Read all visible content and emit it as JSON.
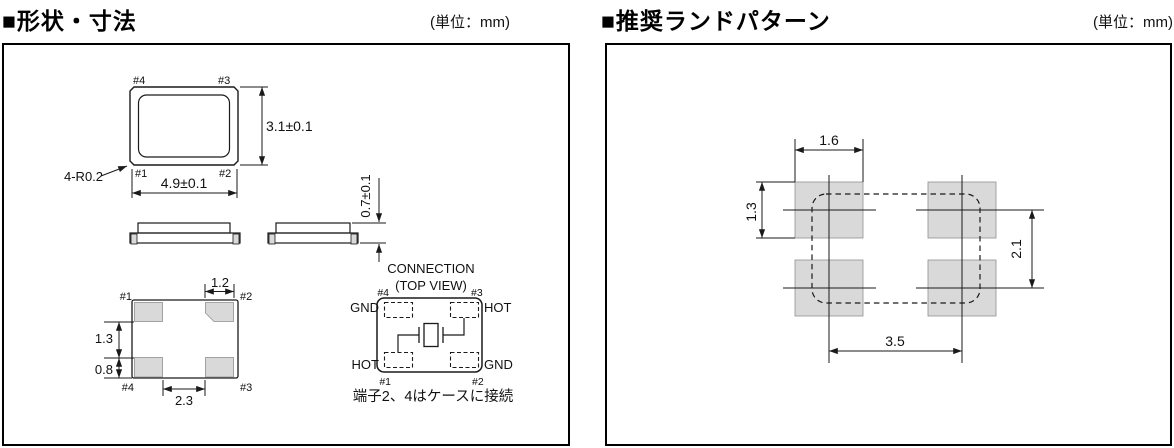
{
  "colors": {
    "pad_fill": "#d9d9d9",
    "line": "#1a1a1a"
  },
  "shape_section": {
    "title": "■形状・寸法",
    "unit": "(単位：mm)",
    "top_view": {
      "pin_tl": "#4",
      "pin_tr": "#3",
      "pin_bl": "#1",
      "pin_br": "#2",
      "dim_width": "4.9±0.1",
      "dim_height": "3.1±0.1",
      "corner_note": "4-R0.2"
    },
    "side_view": {
      "dim_height": "0.7±0.1"
    },
    "bottom_view": {
      "pin_tl": "#1",
      "pin_tr": "#2",
      "pin_bl": "#4",
      "pin_br": "#3",
      "dim_pad_width": "1.2",
      "dim_pad_gap": "1.3",
      "dim_pad_height": "0.8",
      "dim_pad_span": "2.3"
    },
    "connection": {
      "title": "CONNECTION",
      "subtitle": "(TOP VIEW)",
      "pin_tl": "#4",
      "pin_tr": "#3",
      "pin_bl": "#1",
      "pin_br": "#2",
      "label_tl": "GND",
      "label_tr": "HOT",
      "label_bl": "HOT",
      "label_br": "GND",
      "note": "端子2、4はケースに接続"
    }
  },
  "land_section": {
    "title": "■推奨ランドパターン",
    "unit": "(単位：mm)",
    "dims": {
      "pad_width": "1.6",
      "pad_height": "1.3",
      "row_pitch": "2.1",
      "col_pitch": "3.5"
    }
  }
}
